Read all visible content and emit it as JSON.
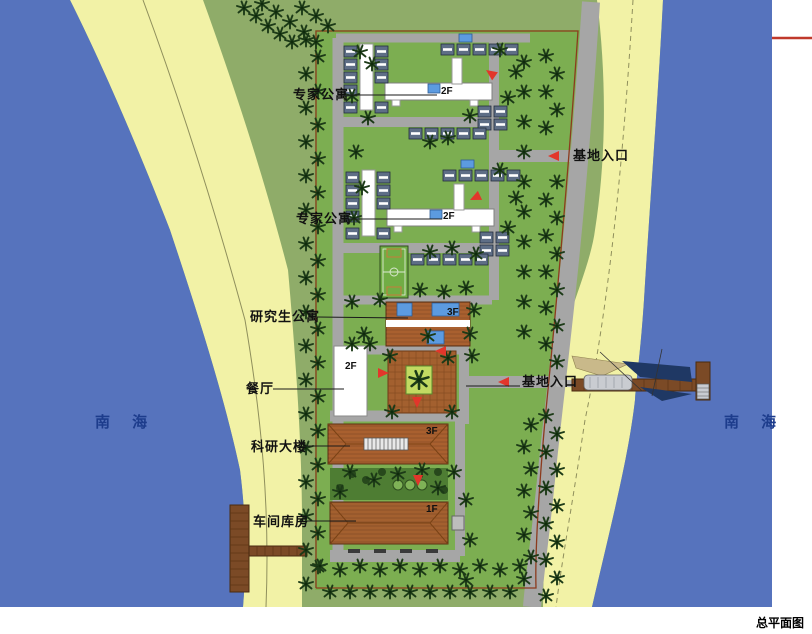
{
  "drawing": {
    "title": "总平面图",
    "sea_left": "南 海",
    "sea_right": "南 海"
  },
  "annotations": {
    "expert_apartment_1": "专家公寓",
    "base_entrance_1": "基地入口",
    "expert_apartment_2": "专家公寓",
    "graduate_apartment": "研究生公寓",
    "dining_hall": "餐厅",
    "base_entrance_2": "基地入口",
    "research_building": "科研大楼",
    "workshop_warehouse": "车间库房"
  },
  "floor_labels": {
    "expert_apartment_1": "2F",
    "expert_apartment_2": "2F",
    "graduate_apartment": "3F",
    "dining_hall": "2F",
    "research_building": "3F",
    "workshop_warehouse": "1F"
  },
  "colors": {
    "sea": "#5673BD",
    "beach": "#F2F2A6",
    "land": "#8FAC69",
    "site_lawn": "#7CAE51",
    "road": "#A6A6A6",
    "roof_terracotta": "#A9602F",
    "unit_roof": "#5E6E86",
    "tree": "#1C3A17",
    "marker_red": "#E2362B",
    "boundary_line": "#8C3B1E",
    "corner_red_line": "#C0392B"
  }
}
